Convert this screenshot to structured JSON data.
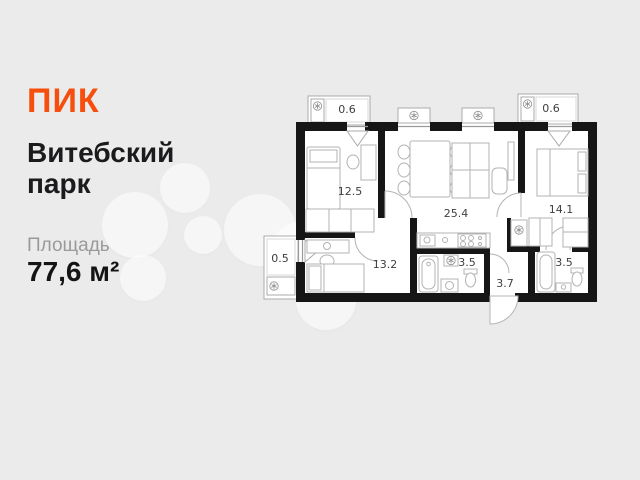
{
  "brand": {
    "logo_text": "ПИК",
    "logo_color": "#F64E0C"
  },
  "project": {
    "line1": "Витебский",
    "line2": "парк"
  },
  "area": {
    "label": "Площадь",
    "value": "77,6 м²"
  },
  "floor_plan": {
    "room_labels": {
      "bedroom1": "12.5",
      "kitchen_living": "25.4",
      "bedroom2": "14.1",
      "bedroom3": "13.2",
      "bathroom1": "3.5",
      "hallway": "3.7",
      "bathroom2": "3.5",
      "balcony_top_left": "0.6",
      "balcony_top_right": "0.6",
      "balcony_left": "0.5"
    },
    "icons": {
      "ventilation": "fan-icon"
    },
    "colors": {
      "walls": "#161616",
      "furniture_outline": "#b3b3b3",
      "floor": "#ffffff",
      "background": "#ebebeb"
    }
  }
}
